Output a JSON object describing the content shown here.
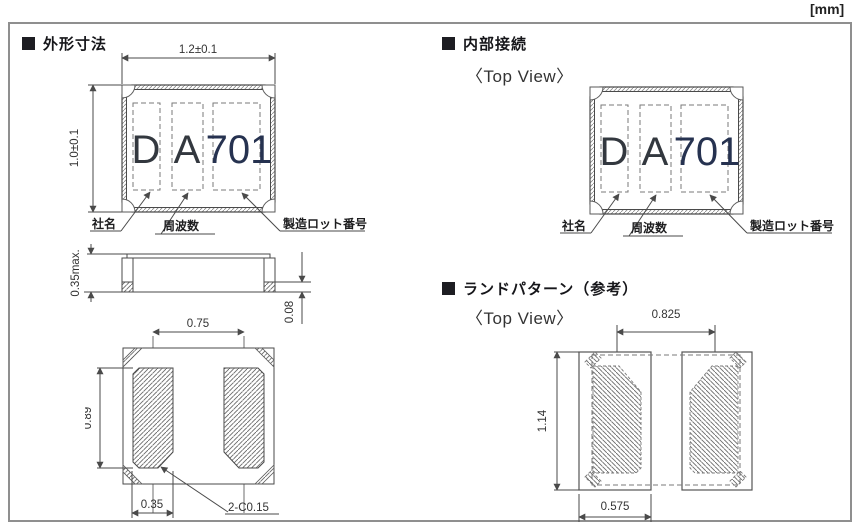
{
  "page": {
    "unit_label": "[mm]"
  },
  "sections": {
    "outline": {
      "title": "外形寸法"
    },
    "internal": {
      "title": "内部接続",
      "view_label": "〈Top View〉"
    },
    "land": {
      "title": "ランドパターン（参考）",
      "view_label": "〈Top View〉"
    }
  },
  "marking": {
    "company_char": "D",
    "type_char": "A",
    "code": "701"
  },
  "marking_labels": {
    "company": "社名",
    "frequency": "周波数",
    "lot": "製造ロット番号"
  },
  "dimensions": {
    "outline_width": "1.2±0.1",
    "outline_height": "1.0±0.1",
    "body_thickness": "0.35max.",
    "terminal_plating_thickness": "0.08",
    "terminal_pitch": "0.75",
    "terminal_length": "0.89",
    "terminal_width": "0.35",
    "chamfer": "2-C0.15",
    "land_pitch": "0.825",
    "land_length": "1.14",
    "land_width": "0.575"
  },
  "colors": {
    "frame": "#8f8f8f",
    "line": "#4a4a4a",
    "marking_text": "#33383f",
    "marking_code": "#263250"
  }
}
